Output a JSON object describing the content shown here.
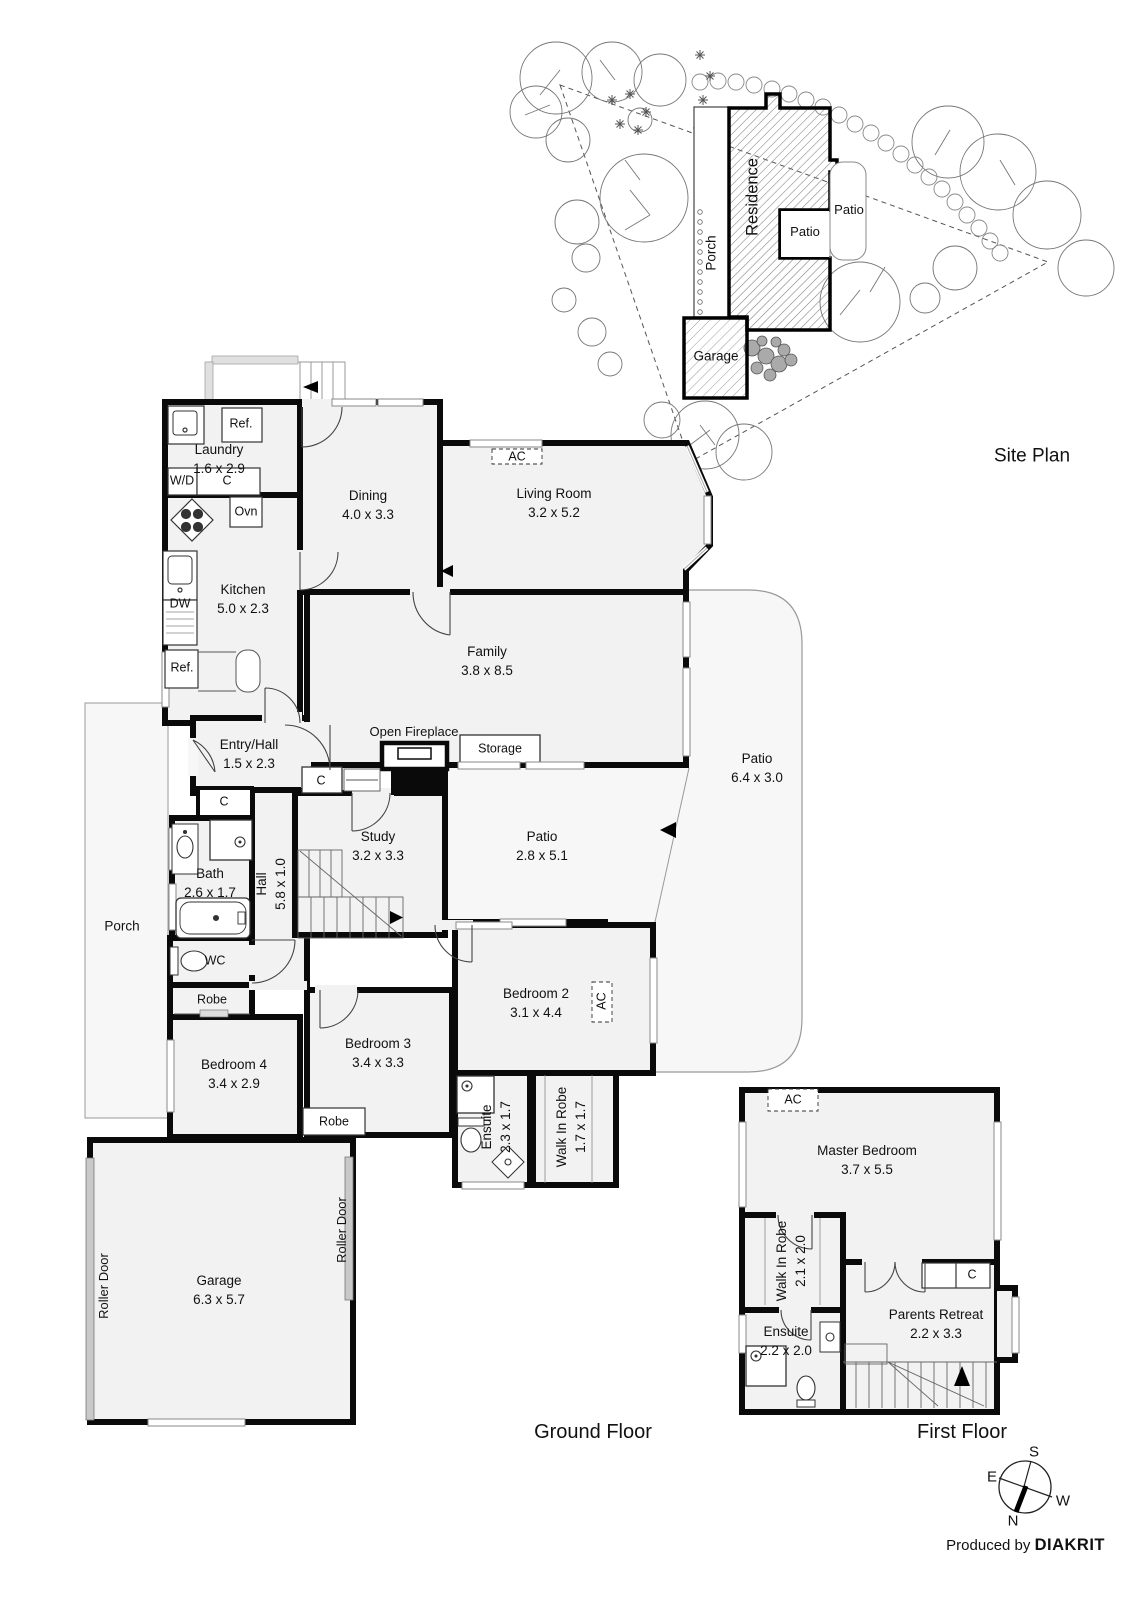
{
  "site_plan": {
    "title": "Site Plan",
    "residence": "Residence",
    "porch": "Porch",
    "patio_inner": "Patio",
    "patio_outer": "Patio",
    "garage": "Garage"
  },
  "ground_floor": {
    "title": "Ground Floor",
    "laundry": {
      "name": "Laundry",
      "dims": "1.6 x 2.9"
    },
    "ref_top": "Ref.",
    "wd": "W/D",
    "c_laundry": "C",
    "ovn": "Ovn",
    "dw": "DW",
    "ref_bottom": "Ref.",
    "kitchen": {
      "name": "Kitchen",
      "dims": "5.0 x 2.3"
    },
    "dining": {
      "name": "Dining",
      "dims": "4.0 x 3.3"
    },
    "ac_living": "AC",
    "living": {
      "name": "Living Room",
      "dims": "3.2 x 5.2"
    },
    "family": {
      "name": "Family",
      "dims": "3.8 x 8.5"
    },
    "entry": {
      "name": "Entry/Hall",
      "dims": "1.5 x 2.3"
    },
    "open_fireplace": "Open Fireplace",
    "storage": "Storage",
    "c_hall": "C",
    "c_study": "C",
    "bath": {
      "name": "Bath",
      "dims": "2.6 x 1.7"
    },
    "hall": {
      "name": "Hall",
      "dims": "5.8 x 1.0"
    },
    "study": {
      "name": "Study",
      "dims": "3.2 x 3.3"
    },
    "patio_small": {
      "name": "Patio",
      "dims": "2.8 x 5.1"
    },
    "patio_large": {
      "name": "Patio",
      "dims": "6.4 x 3.0"
    },
    "wc": "WC",
    "robe_hall": "Robe",
    "bedroom2": {
      "name": "Bedroom 2",
      "dims": "3.1 x 4.4"
    },
    "ac_bedroom2": "AC",
    "bedroom4": {
      "name": "Bedroom 4",
      "dims": "3.4 x 2.9"
    },
    "bedroom3": {
      "name": "Bedroom 3",
      "dims": "3.4 x 3.3"
    },
    "robe_bedroom3": "Robe",
    "ensuite": {
      "name": "Ensuite",
      "dims": "2.3 x 1.7"
    },
    "walk_in_robe": {
      "name": "Walk In Robe",
      "dims": "1.7 x 1.7"
    },
    "garage": {
      "name": "Garage",
      "dims": "6.3 x 5.7"
    },
    "roller_door_left": "Roller Door",
    "roller_door_right": "Roller Door",
    "porch": "Porch"
  },
  "first_floor": {
    "title": "First Floor",
    "ac": "AC",
    "master_bedroom": {
      "name": "Master Bedroom",
      "dims": "3.7 x 5.5"
    },
    "walk_in_robe": {
      "name": "Walk In Robe",
      "dims": "2.1 x 2.0"
    },
    "c_closet": "C",
    "parents_retreat": {
      "name": "Parents Retreat",
      "dims": "2.2 x 3.3"
    },
    "ensuite": {
      "name": "Ensuite",
      "dims": "2.2 x 2.0"
    }
  },
  "compass": {
    "n": "N",
    "s": "S",
    "e": "E",
    "w": "W"
  },
  "footer": {
    "produced_by": "Produced by",
    "brand": "DIAKRIT"
  }
}
